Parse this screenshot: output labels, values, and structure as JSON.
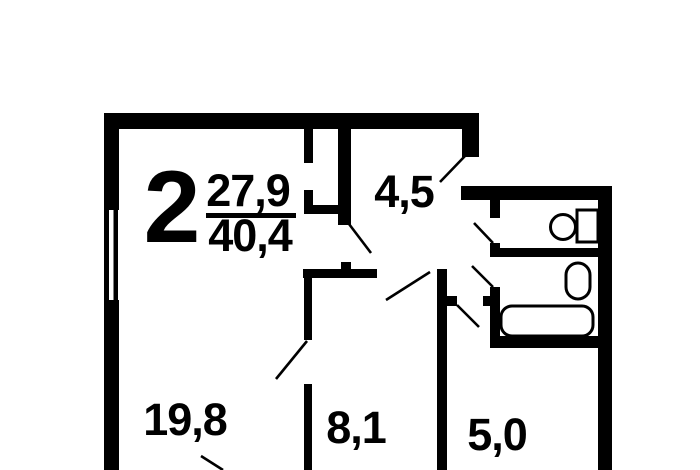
{
  "plan": {
    "summary": {
      "rooms_count": "2",
      "living_area": "27,9",
      "total_area": "40,4"
    },
    "rooms": [
      {
        "id": "hallway",
        "area": "4,5"
      },
      {
        "id": "living-room",
        "area": "19,8"
      },
      {
        "id": "kitchen",
        "area": "8,1"
      },
      {
        "id": "corridor",
        "area": "5,0"
      }
    ],
    "fixtures": [
      "toilet-icon",
      "washbasin-icon",
      "bathtub-icon",
      "window-icon"
    ],
    "colors": {
      "ink": "#000000",
      "background": "#ffffff"
    }
  }
}
